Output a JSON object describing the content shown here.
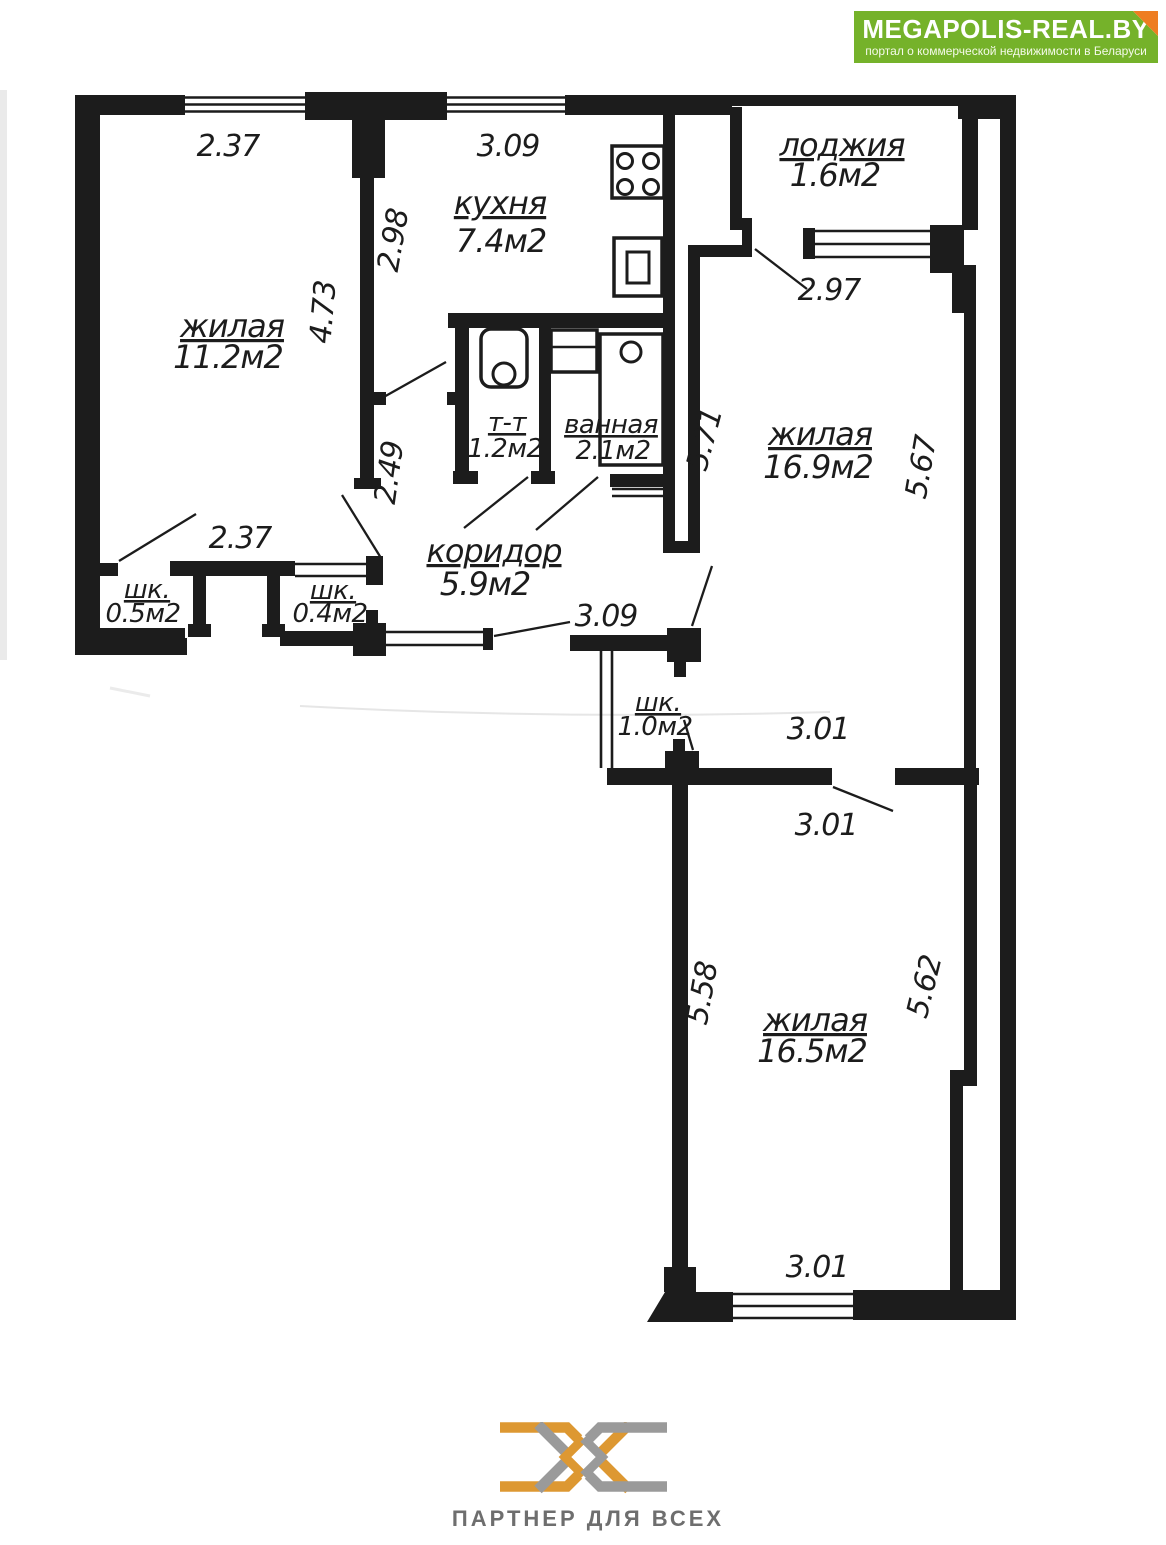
{
  "header": {
    "title": "MEGAPOLIS-REAL.BY",
    "subtitle": "портал о коммерческой недвижимости в Беларуси",
    "colors": {
      "green": "#75b22a",
      "fold_orange": "#ee7d22"
    }
  },
  "plan": {
    "rooms": {
      "living_top_left": {
        "name": "жилая",
        "area": "11.2м2"
      },
      "kitchen": {
        "name": "кухня",
        "area": "7.4м2"
      },
      "loggia": {
        "name": "лоджия",
        "area": "1.6м2"
      },
      "living_right": {
        "name": "жилая",
        "area": "16.9м2"
      },
      "toilet": {
        "name": "т-т",
        "area": "1.2м2"
      },
      "bathroom": {
        "name": "ванная",
        "area": "2.1м2"
      },
      "corridor": {
        "name": "коридор",
        "area": "5.9м2"
      },
      "closet_left": {
        "name": "шк.",
        "area": "0.5м2"
      },
      "closet_right": {
        "name": "шк.",
        "area": "0.4м2"
      },
      "closet_mid": {
        "name": "шк.",
        "area": "1.0м2"
      },
      "living_bottom": {
        "name": "жилая",
        "area": "16.5м2"
      }
    },
    "dimensions": {
      "room1_width": "2.37",
      "kitchen_width": "3.09",
      "kitchen_depth": "2.98",
      "room1_depth": "4.73",
      "divider_lower": "2.49",
      "loggia_width": "2.97",
      "room2_depth_left": "5.71",
      "room2_depth_right": "5.67",
      "hall_width": "2.37",
      "corridor_width": "3.09",
      "closet_row_width": "3.01",
      "room3_width_top": "3.01",
      "room3_depth_left": "5.58",
      "room3_depth_right": "5.62",
      "room3_width_bottom": "3.01"
    },
    "fixtures": [
      "stove-icon",
      "fridge-icon",
      "toilet-icon",
      "sink-icon",
      "bathtub-icon"
    ],
    "line_color": "#1c1c1c"
  },
  "footer": {
    "tagline": "ПАРТНЕР ДЛЯ ВСЕХ",
    "colors": {
      "orange": "#dd9832",
      "gray": "#9a9a9a"
    }
  }
}
